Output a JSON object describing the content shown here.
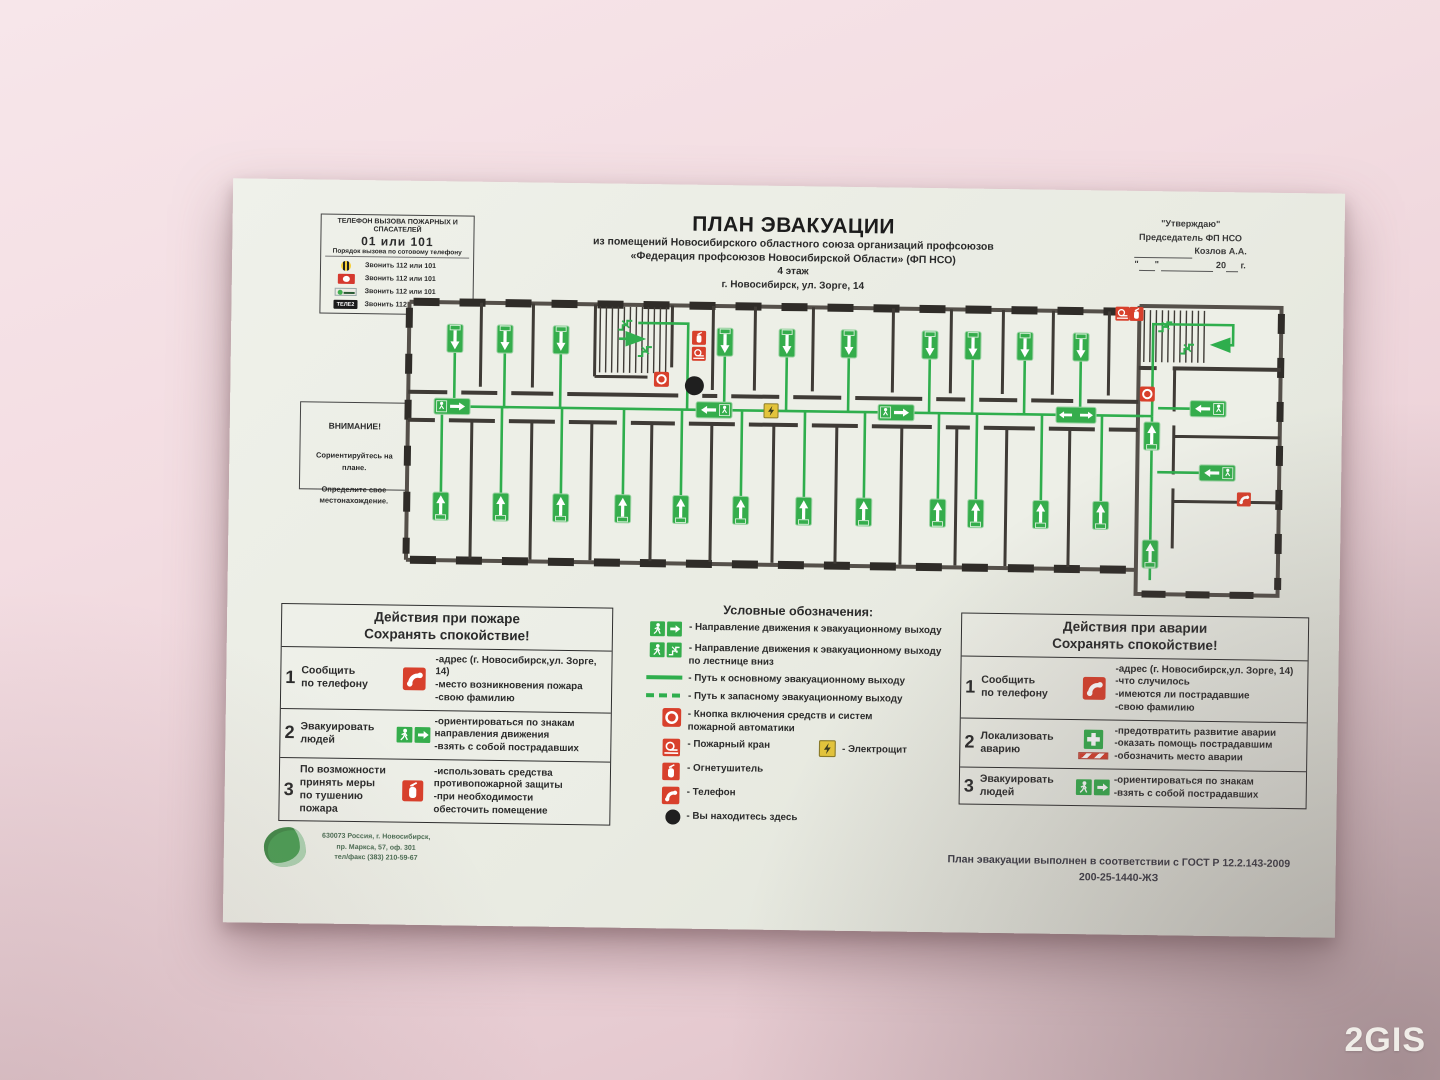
{
  "colors": {
    "safety_green": "#35ad4c",
    "safety_red": "#d8402c",
    "electro_yellow": "#e3c43c",
    "wall_pink": "#f1d9de"
  },
  "watermark": "2GIS",
  "phones_box": {
    "title": "ТЕЛЕФОН ВЫЗОВА ПОЖАРНЫХ И СПАСАТЕЛЕЙ",
    "number": "01 или 101",
    "subtitle": "Порядок вызова по сотовому телефону",
    "tele2_label": "ТЕЛЕ2",
    "rows": [
      {
        "operator": "beeline",
        "text": "Звонить 112 или 101"
      },
      {
        "operator": "mts",
        "text": "Звонить 112 или 101"
      },
      {
        "operator": "megafon",
        "text": "Звонить 112 или 101"
      },
      {
        "operator": "tele2",
        "text": "Звонить 112 или 101"
      }
    ]
  },
  "title_block": {
    "title": "ПЛАН ЭВАКУАЦИИ",
    "line1": "из помещений Новосибирского областного союза  организаций профсоюзов",
    "line2": "«Федерация профсоюзов Новосибирской Области» (ФП НСО)",
    "line3": "4 этаж",
    "line4": "г. Новосибирск, ул. Зорге, 14"
  },
  "approval_block": {
    "line1": "\"Утверждаю\"",
    "line2": "Председатель ФП НСО",
    "name": "Козлов А.А.",
    "year_prefix": "20",
    "year_suffix": "г."
  },
  "attention_box": {
    "title": "ВНИМАНИЕ!",
    "lines": [
      "Сориентируйтесь на плане.",
      "",
      "Определите свое местонахождение."
    ]
  },
  "fire_actions": {
    "title_line1": "Действия при пожаре",
    "title_line2": "Сохранять спокойствие!",
    "rows": [
      {
        "num": "1",
        "action_lines": [
          "Сообщить",
          "по телефону"
        ],
        "icon": "phone",
        "details": [
          "-адрес (г. Новосибирск,ул. Зорге, 14)",
          "-место возникновения пожара",
          "-свою фамилию"
        ]
      },
      {
        "num": "2",
        "action_lines": [
          "Эвакуировать",
          "людей"
        ],
        "icon": "exit-sign",
        "details": [
          "-ориентироваться по знакам",
          "направления движения",
          "-взять с собой пострадавших"
        ]
      },
      {
        "num": "3",
        "action_lines": [
          "По возможности",
          "принять меры",
          "по тушению",
          "пожара"
        ],
        "icon": "extinguisher",
        "details": [
          "-использовать средства",
          "противопожарной защиты",
          "-при необходимости",
          "обесточить помещение"
        ]
      }
    ]
  },
  "legend": {
    "title": "Условные обозначения:",
    "items": [
      {
        "icon": "exit-man-arrow",
        "lines": [
          "- Направление движения к эвакуационному выходу"
        ]
      },
      {
        "icon": "exit-man-stairs",
        "lines": [
          "- Направление движения к эвакуационному выходу",
          "по лестнице вниз"
        ]
      },
      {
        "icon": "solid-line",
        "lines": [
          "- Путь к основному эвакуационному выходу"
        ]
      },
      {
        "icon": "dashed-line",
        "lines": [
          "- Путь к запасному эвакуационному выходу"
        ]
      },
      {
        "icon": "fire-button",
        "lines": [
          "- Кнопка включения средств и систем",
          "пожарной автоматики"
        ]
      },
      {
        "icon": "fire-hose",
        "lines": [
          "- Пожарный кран"
        ]
      },
      {
        "icon": "extinguisher",
        "lines": [
          "- Огнетушитель"
        ]
      },
      {
        "icon": "phone",
        "lines": [
          "- Телефон"
        ]
      },
      {
        "icon": "you-are-here",
        "lines": [
          "- Вы находитесь здесь"
        ]
      }
    ],
    "electro_label": "- Электрощит"
  },
  "accident_actions": {
    "title_line1": "Действия при аварии",
    "title_line2": "Сохранять спокойствие!",
    "rows": [
      {
        "num": "1",
        "action_lines": [
          "Сообщить",
          "по телефону"
        ],
        "icon": "phone",
        "details": [
          "-адрес (г. Новосибирск,ул. Зорге, 14)",
          "-что случилось",
          "-имеются ли пострадавшие",
          "-свою фамилию"
        ]
      },
      {
        "num": "2",
        "action_lines": [
          "Локализовать",
          "аварию"
        ],
        "icon": "first-aid",
        "details": [
          "-предотвратить развитие аварии",
          "-оказать помощь пострадавшим",
          "-обозначить место аварии"
        ]
      },
      {
        "num": "3",
        "action_lines": [
          "Эвакуировать",
          "людей"
        ],
        "icon": "exit-sign",
        "details": [
          "-ориентироваться по знакам",
          "-взять с собой пострадавших"
        ]
      }
    ]
  },
  "footer": {
    "address_lines": [
      "630073 Россия, г. Новосибирск,",
      "пр. Маркса, 57, оф. 301",
      "тел/факс (383) 210-59-67"
    ],
    "gost_line1": "План эвакуации выполнен в соответствии с ГОСТ Р 12.2.143-2009",
    "gost_line2": "200-25-1440-ЖЗ"
  }
}
